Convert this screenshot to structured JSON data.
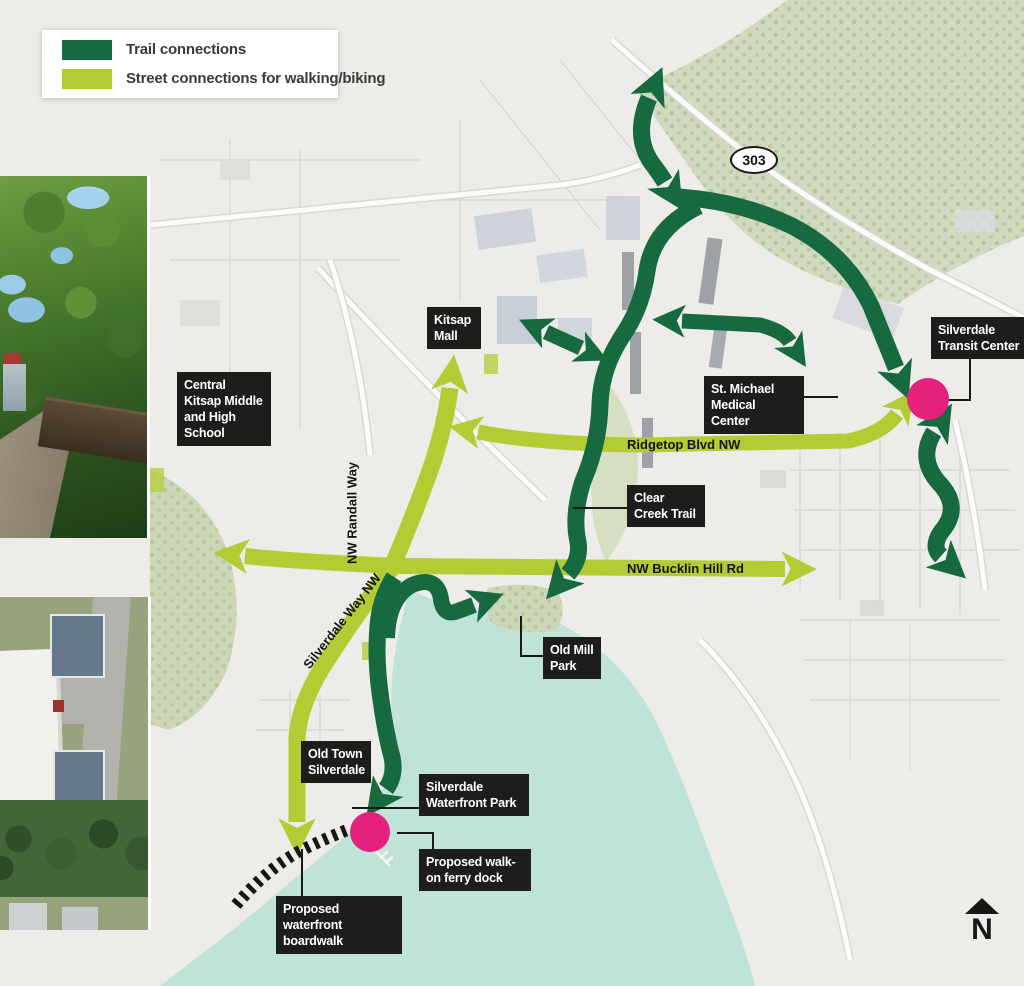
{
  "legend": {
    "items": [
      {
        "label": "Trail connections",
        "color": "#176a40"
      },
      {
        "label": "Street connections for walking/biking",
        "color": "#b4cc34"
      }
    ]
  },
  "map": {
    "route_shield": "303",
    "north_label": "N",
    "labels": {
      "kitsap_mall": "Kitsap Mall",
      "school": "Central Kitsap Middle and High School",
      "medical": "St. Michael Medical Center",
      "transit": "Silverdale Transit Center",
      "clear_creek": "Clear Creek Trail",
      "old_mill": "Old Mill Park",
      "old_town": "Old Town Silverdale",
      "waterfront_park": "Silverdale Waterfront Park",
      "ferry": "Proposed walk-on ferry dock",
      "boardwalk": "Proposed waterfront boardwalk"
    },
    "streets": {
      "ridgetop": "Ridgetop Blvd NW",
      "bucklin": "NW Bucklin Hill Rd",
      "randall": "NW Randall Way",
      "silverdale_way": "Silverdale Way NW"
    },
    "colors": {
      "trail_green": "#176a40",
      "street_green": "#b4cc34",
      "marker_pink": "#e5217e",
      "water": "#bfe2d9"
    }
  }
}
